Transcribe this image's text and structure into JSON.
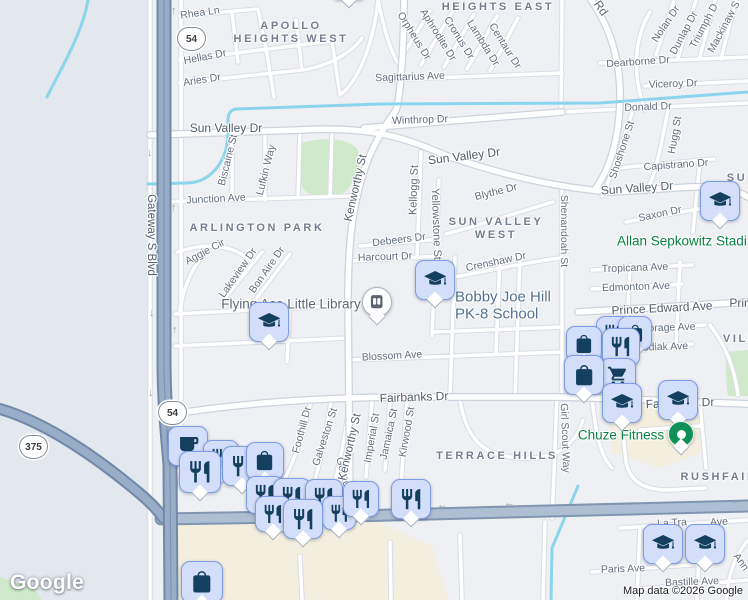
{
  "map": {
    "logo": "Google",
    "attribution": "Map data ©2026 Google",
    "colors": {
      "background": "#eef0f3",
      "west_area": "#e3e7ee",
      "water": "#8ad5ec",
      "park": "#cfe9ca",
      "commercial": "#f3eedd",
      "minor_road": "#ffffff",
      "minor_casing": "#d9dde4",
      "artery_fill": "#aebfd3",
      "artery_casing": "#8095b0",
      "highway_fill": "#98adc8",
      "highway_casing": "#7089a8",
      "marker_fill": "#d2defa",
      "marker_border": "#7d9ce6",
      "marker_glyph": "#143f5e",
      "poi_green": "#0b8043",
      "poi_blue_gray": "#54718f",
      "street_text": "#646e7e",
      "district_text": "#747d8d"
    },
    "shields": [
      {
        "label": "54",
        "x": 190,
        "y": 38
      },
      {
        "label": "54",
        "x": 171,
        "y": 412
      },
      {
        "label": "375",
        "x": 32,
        "y": 446
      }
    ],
    "district_labels": [
      {
        "t": "APOLLO",
        "x": 291,
        "y": 26
      },
      {
        "t": "HEIGHTS WEST",
        "x": 291,
        "y": 39
      },
      {
        "t": "HEIGHTS EAST",
        "x": 498,
        "y": 7
      },
      {
        "t": "ARLINGTON PARK",
        "x": 257,
        "y": 228
      },
      {
        "t": "SUN VALLEY",
        "x": 496,
        "y": 222
      },
      {
        "t": "WEST",
        "x": 496,
        "y": 235
      },
      {
        "t": "TERRACE HILLS",
        "x": 497,
        "y": 456
      },
      {
        "t": "RUSHFAIR",
        "x": 719,
        "y": 477
      },
      {
        "t": "VILL",
        "x": 740,
        "y": 339
      },
      {
        "t": "SU",
        "x": 737,
        "y": 178
      }
    ],
    "street_labels": [
      {
        "t": "Rhea Ln",
        "x": 200,
        "y": 13,
        "r": -8
      },
      {
        "t": "Hellas Dr",
        "x": 205,
        "y": 57,
        "r": -11
      },
      {
        "t": "Aries Dr",
        "x": 202,
        "y": 80,
        "r": -9
      },
      {
        "t": "Sun Valley Dr",
        "x": 226,
        "y": 128,
        "r": 0,
        "s": 12,
        "c": "#525d6c"
      },
      {
        "t": "Sun Valley Dr",
        "x": 464,
        "y": 156,
        "r": -7,
        "s": 12,
        "c": "#525d6c"
      },
      {
        "t": "Sun Valley Dr",
        "x": 637,
        "y": 188,
        "r": -4,
        "s": 12,
        "c": "#525d6c"
      },
      {
        "t": "Winthrop Dr",
        "x": 420,
        "y": 120,
        "r": -2
      },
      {
        "t": "Sagittarius Ave",
        "x": 410,
        "y": 77,
        "r": -2
      },
      {
        "t": "Orpheus Dr",
        "x": 414,
        "y": 36,
        "r": 58
      },
      {
        "t": "Aphrodite Dr",
        "x": 438,
        "y": 35,
        "r": 58
      },
      {
        "t": "Cronus Dr",
        "x": 459,
        "y": 38,
        "r": 58
      },
      {
        "t": "Lambda Dr",
        "x": 483,
        "y": 43,
        "r": 58
      },
      {
        "t": "Centaur Dr",
        "x": 505,
        "y": 46,
        "r": 58
      },
      {
        "t": "Rd",
        "x": 601,
        "y": 8,
        "r": 55,
        "s": 12,
        "c": "#5d6673"
      },
      {
        "t": "Nolan Dr",
        "x": 666,
        "y": 24,
        "r": -56
      },
      {
        "t": "Dunlap Dr",
        "x": 684,
        "y": 33,
        "r": -62
      },
      {
        "t": "Triumph D",
        "x": 704,
        "y": 26,
        "r": -62
      },
      {
        "t": "Mackinaw S",
        "x": 724,
        "y": 27,
        "r": -62
      },
      {
        "t": "Dearborne Dr",
        "x": 638,
        "y": 62,
        "r": -4
      },
      {
        "t": "Viceroy Dr",
        "x": 673,
        "y": 84,
        "r": -2
      },
      {
        "t": "Donald Dr",
        "x": 648,
        "y": 107,
        "r": -2
      },
      {
        "t": "Shoshone St",
        "x": 622,
        "y": 150,
        "r": -72
      },
      {
        "t": "Hugg St",
        "x": 675,
        "y": 135,
        "r": -80
      },
      {
        "t": "Capistrano Dr",
        "x": 676,
        "y": 165,
        "r": -4
      },
      {
        "t": "Saxon Dr",
        "x": 660,
        "y": 214,
        "r": -12
      },
      {
        "t": "Shenandoah St",
        "x": 564,
        "y": 231,
        "r": 90
      },
      {
        "t": "Blythe Dr",
        "x": 496,
        "y": 192,
        "r": -14
      },
      {
        "t": "Crenshaw Dr",
        "x": 496,
        "y": 262,
        "r": -12
      },
      {
        "t": "Junction Ave",
        "x": 216,
        "y": 199,
        "r": -3
      },
      {
        "t": "Biscaine St",
        "x": 228,
        "y": 160,
        "r": -76
      },
      {
        "t": "Lufkin Way",
        "x": 266,
        "y": 170,
        "r": -76
      },
      {
        "t": "Kenworthy St",
        "x": 356,
        "y": 188,
        "r": -77,
        "s": 11.5,
        "c": "#525d6c"
      },
      {
        "t": "Kellogg St",
        "x": 414,
        "y": 190,
        "r": -88,
        "s": 11
      },
      {
        "t": "Yellowstone St",
        "x": 436,
        "y": 224,
        "r": 88,
        "s": 11
      },
      {
        "t": "Debeers Dr",
        "x": 399,
        "y": 240,
        "r": -7
      },
      {
        "t": "Harcourt Dr",
        "x": 385,
        "y": 257,
        "r": -2
      },
      {
        "t": "Aggie Cir",
        "x": 205,
        "y": 252,
        "r": -28
      },
      {
        "t": "Lakeview Dr",
        "x": 238,
        "y": 273,
        "r": -55
      },
      {
        "t": "Bon Aire Dr",
        "x": 267,
        "y": 270,
        "r": -55
      },
      {
        "t": "Blossom Ave",
        "x": 392,
        "y": 356,
        "r": -3
      },
      {
        "t": "Tropicana Ave",
        "x": 635,
        "y": 268,
        "r": -2
      },
      {
        "t": "Edmonton Ave",
        "x": 636,
        "y": 287,
        "r": -2
      },
      {
        "t": "Prince Edward Ave",
        "x": 662,
        "y": 308,
        "r": -3,
        "s": 12,
        "c": "#525d6c"
      },
      {
        "t": "Prin",
        "x": 740,
        "y": 303,
        "r": 0,
        "s": 12,
        "c": "#525d6c"
      },
      {
        "t": "Anchorage Ave",
        "x": 660,
        "y": 328,
        "r": -2
      },
      {
        "t": "Kodiak Ave",
        "x": 662,
        "y": 347,
        "r": -2
      },
      {
        "t": "Fairbanks Dr",
        "x": 414,
        "y": 397,
        "r": -2,
        "s": 12,
        "c": "#525d6c"
      },
      {
        "t": "Fairbanks Dr",
        "x": 680,
        "y": 403,
        "r": -2,
        "s": 12,
        "c": "#525d6c"
      },
      {
        "t": "Foothill Dr",
        "x": 302,
        "y": 430,
        "r": -75
      },
      {
        "t": "Galveston St",
        "x": 325,
        "y": 437,
        "r": -72
      },
      {
        "t": "Goliad",
        "x": 343,
        "y": 472,
        "r": 75
      },
      {
        "t": "Kenworthy St",
        "x": 350,
        "y": 447,
        "r": -77,
        "s": 11.5,
        "c": "#525d6c"
      },
      {
        "t": "Imperial St",
        "x": 372,
        "y": 438,
        "r": -80
      },
      {
        "t": "Jamaica St",
        "x": 389,
        "y": 434,
        "r": -78
      },
      {
        "t": "Kirwood St",
        "x": 407,
        "y": 432,
        "r": -80
      },
      {
        "t": "Girl Scout Way",
        "x": 565,
        "y": 438,
        "r": 88
      },
      {
        "t": "Gateway S Blvd",
        "x": 151,
        "y": 235,
        "r": 90,
        "s": 11.5,
        "c": "#525d6c"
      },
      {
        "t": "La Tra",
        "x": 672,
        "y": 523,
        "r": -3
      },
      {
        "t": "Ave",
        "x": 719,
        "y": 522,
        "r": -3
      },
      {
        "t": "Paris Ave",
        "x": 623,
        "y": 569,
        "r": -2
      },
      {
        "t": "Bastille Ave",
        "x": 692,
        "y": 582,
        "r": -2
      },
      {
        "t": "Ann",
        "x": 741,
        "y": 562,
        "r": 55
      }
    ],
    "poi_labels": [
      {
        "t": "Flying Ace Little Library",
        "x": 291,
        "y": 304,
        "c": "#5e6874",
        "s": 13.5
      },
      {
        "t": "Bobby Joe Hill",
        "x": 455,
        "y": 297,
        "c": "#54718f",
        "s": 15,
        "a": "left"
      },
      {
        "t": "PK-8 School",
        "x": 455,
        "y": 314,
        "c": "#54718f",
        "s": 15,
        "a": "left"
      },
      {
        "t": "Allan Sepkowitz Stadi",
        "x": 617,
        "y": 241,
        "c": "#0b8043",
        "s": 13.5,
        "a": "left"
      },
      {
        "t": "Chuze Fitness",
        "x": 621,
        "y": 435,
        "c": "#0b8043",
        "s": 13.5
      }
    ],
    "markers": [
      {
        "n": "school-marker",
        "i": "graduation-cap",
        "x": 331,
        "y": -36,
        "s": 36
      },
      {
        "n": "restaurant-marker",
        "i": "restaurant",
        "x": 596,
        "y": 316,
        "s": 34
      },
      {
        "n": "store-marker",
        "i": "shopping-bag",
        "x": 618,
        "y": 316,
        "s": 34
      },
      {
        "n": "store-marker",
        "i": "shopping-bag",
        "x": 566,
        "y": 326,
        "s": 36
      },
      {
        "n": "restaurant-marker",
        "i": "restaurant",
        "x": 602,
        "y": 328,
        "s": 38
      },
      {
        "n": "grocery-marker",
        "i": "shopping-cart",
        "x": 600,
        "y": 358,
        "s": 36
      },
      {
        "n": "store-marker",
        "i": "shopping-bag",
        "x": 564,
        "y": 355,
        "s": 40
      },
      {
        "n": "school-marker",
        "i": "graduation-cap",
        "x": 602,
        "y": 383,
        "s": 40
      },
      {
        "n": "school-marker",
        "i": "graduation-cap",
        "x": 658,
        "y": 380,
        "s": 40
      },
      {
        "n": "school-marker",
        "i": "graduation-cap",
        "x": 700,
        "y": 181,
        "s": 40
      },
      {
        "n": "school-marker",
        "i": "graduation-cap",
        "x": 249,
        "y": 302,
        "s": 40
      },
      {
        "n": "school-marker",
        "i": "graduation-cap",
        "x": 415,
        "y": 260,
        "s": 40
      },
      {
        "n": "library-marker",
        "i": "book",
        "x": 362,
        "y": 287,
        "s": 30,
        "t": "pin"
      },
      {
        "n": "fitness-marker",
        "i": "dot",
        "x": 668,
        "y": 421,
        "s": 26,
        "t": "dot"
      },
      {
        "n": "school-marker",
        "i": "graduation-cap",
        "x": 643,
        "y": 524,
        "s": 40
      },
      {
        "n": "school-marker",
        "i": "graduation-cap",
        "x": 685,
        "y": 524,
        "s": 40
      },
      {
        "n": "cafe-marker",
        "i": "coffee",
        "x": 168,
        "y": 426,
        "s": 40
      },
      {
        "n": "restaurant-marker",
        "i": "restaurant",
        "x": 203,
        "y": 440,
        "s": 36
      },
      {
        "n": "restaurant-marker",
        "i": "restaurant",
        "x": 222,
        "y": 446,
        "s": 40
      },
      {
        "n": "store-marker",
        "i": "shopping-bag",
        "x": 246,
        "y": 442,
        "s": 38
      },
      {
        "n": "restaurant-marker",
        "i": "restaurant",
        "x": 179,
        "y": 451,
        "s": 42
      },
      {
        "n": "restaurant-marker",
        "i": "restaurant",
        "x": 246,
        "y": 476,
        "s": 38
      },
      {
        "n": "restaurant-marker",
        "i": "restaurant",
        "x": 273,
        "y": 478,
        "s": 38
      },
      {
        "n": "restaurant-marker",
        "i": "restaurant",
        "x": 305,
        "y": 479,
        "s": 38
      },
      {
        "n": "restaurant-marker",
        "i": "restaurant",
        "x": 322,
        "y": 496,
        "s": 34
      },
      {
        "n": "restaurant-marker",
        "i": "restaurant",
        "x": 343,
        "y": 481,
        "s": 36
      },
      {
        "n": "restaurant-marker",
        "i": "restaurant",
        "x": 255,
        "y": 496,
        "s": 36
      },
      {
        "n": "restaurant-marker",
        "i": "restaurant",
        "x": 283,
        "y": 499,
        "s": 40
      },
      {
        "n": "restaurant-marker",
        "i": "restaurant",
        "x": 391,
        "y": 479,
        "s": 40
      },
      {
        "n": "store-marker",
        "i": "shopping-bag",
        "x": 181,
        "y": 561,
        "s": 42
      }
    ],
    "arrows": [
      {
        "g": "↑",
        "x": 171,
        "y": 6
      },
      {
        "g": "↓",
        "x": 147,
        "y": 148
      },
      {
        "g": "↑",
        "x": 171,
        "y": 203
      },
      {
        "g": "↓",
        "x": 149,
        "y": 308
      },
      {
        "g": "↑",
        "x": 172,
        "y": 325
      },
      {
        "g": "↓",
        "x": 148,
        "y": 388
      },
      {
        "g": "←",
        "x": 437,
        "y": 500
      },
      {
        "g": "←",
        "x": 504,
        "y": 498
      },
      {
        "g": "←",
        "x": 730,
        "y": 496
      }
    ]
  }
}
